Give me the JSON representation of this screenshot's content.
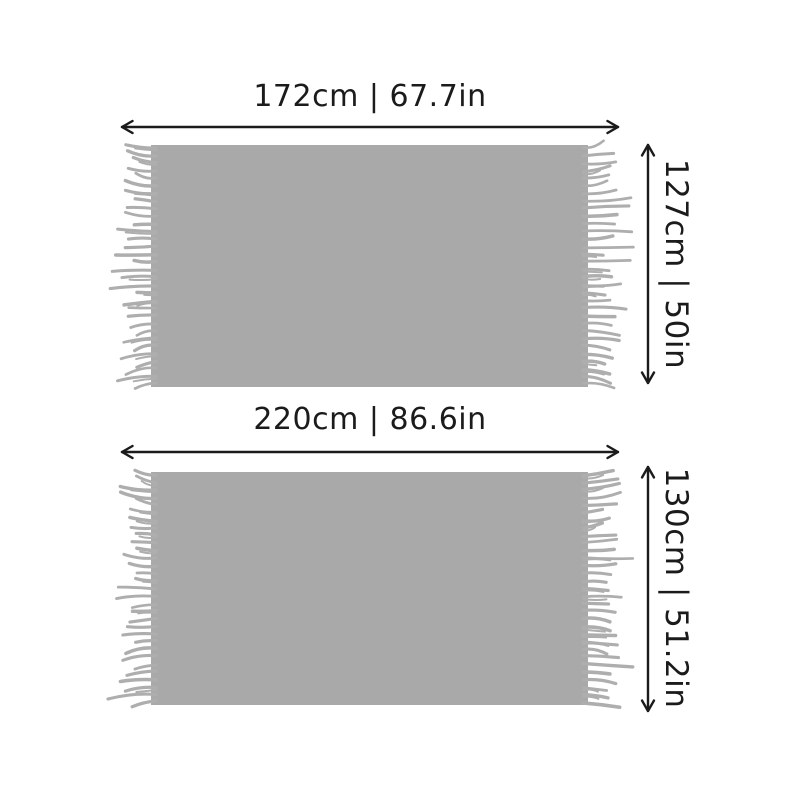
{
  "page": {
    "background": "#ffffff"
  },
  "colors": {
    "blanket": "#a9a9a9",
    "fringe": "#aeaeae",
    "ink": "#1b1b1b"
  },
  "blankets": [
    {
      "width_label": "172cm | 67.7in",
      "height_label": "127cm | 50in"
    },
    {
      "width_label": "220cm | 86.6in",
      "height_label": "130cm | 51.2in"
    }
  ]
}
